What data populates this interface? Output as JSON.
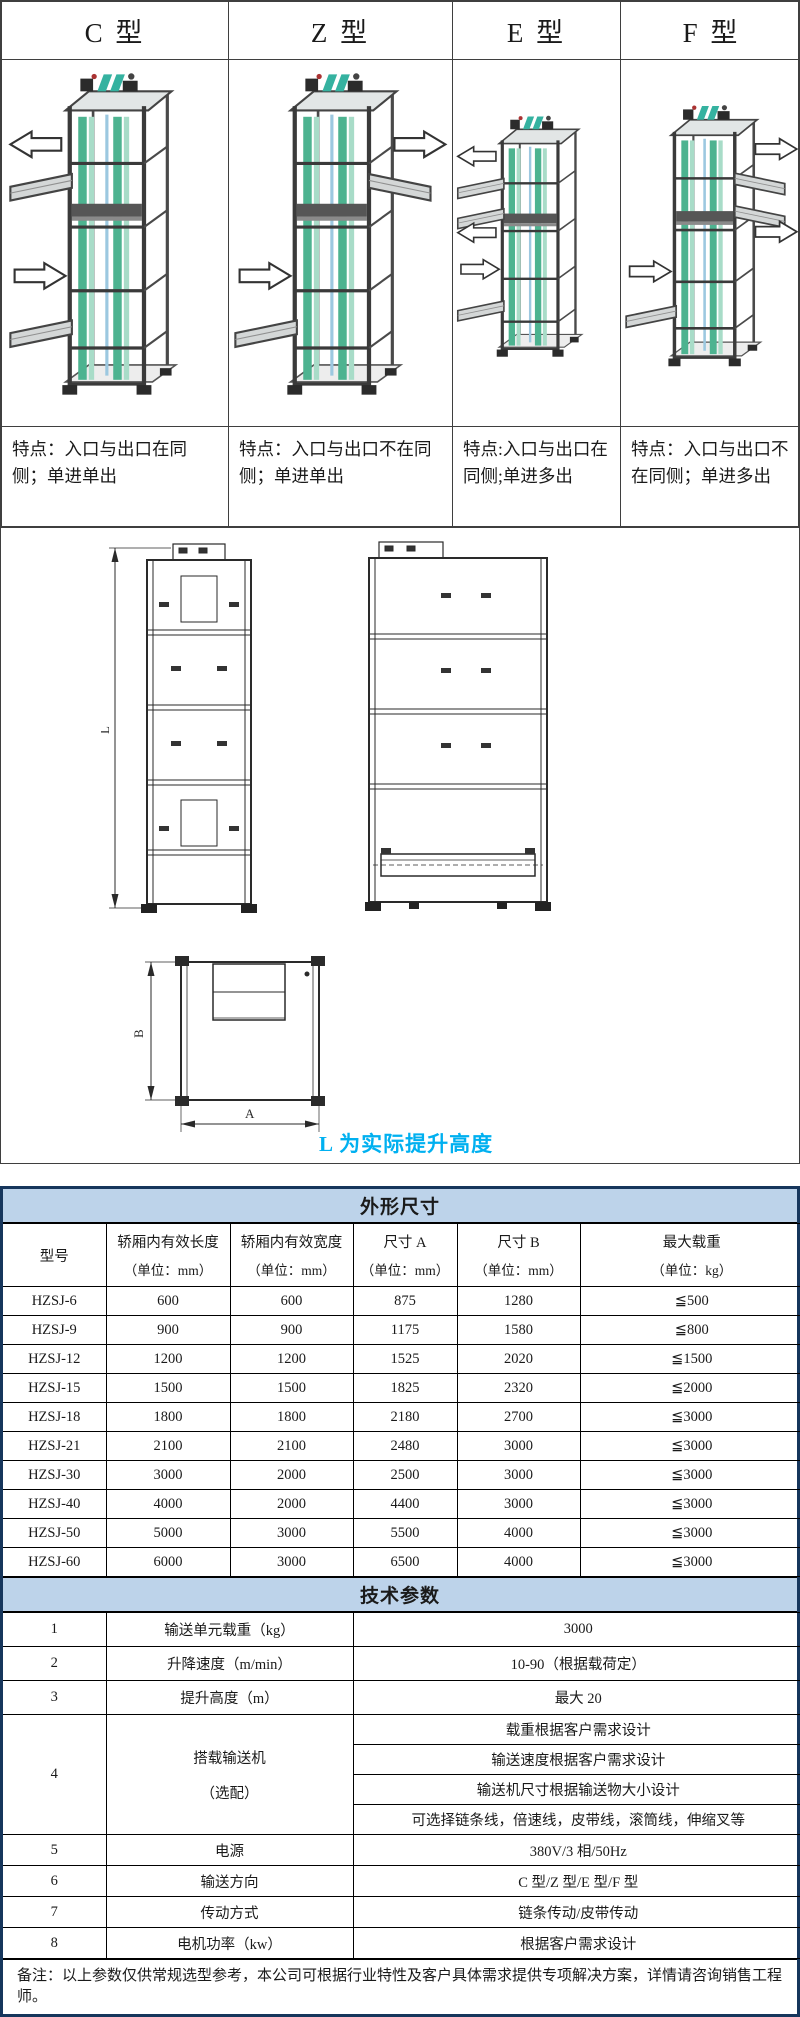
{
  "comparison": {
    "types": [
      {
        "label": "C 型",
        "feature": "特点：入口与出口在同侧；单进单出"
      },
      {
        "label": "Z 型",
        "feature": "特点：入口与出口不在同侧；单进单出"
      },
      {
        "label": "E 型",
        "feature": "特点:入口与出口在同侧;单进多出"
      },
      {
        "label": "F 型",
        "feature": "特点：入口与出口不在同侧；单进多出"
      }
    ]
  },
  "drawing": {
    "dim_l": "L",
    "dim_b": "B",
    "dim_a": "A",
    "note": "L 为实际提升高度",
    "note_color": "#00b0f0"
  },
  "dimensions_table": {
    "title": "外形尺寸",
    "headers": {
      "model": "型号",
      "length": "轿厢内有效长度",
      "length_unit": "（单位：mm）",
      "width": "轿厢内有效宽度",
      "width_unit": "（单位：mm）",
      "dim_a": "尺寸 A",
      "dim_a_unit": "（单位：mm）",
      "dim_b": "尺寸 B",
      "dim_b_unit": "（单位：mm）",
      "load": "最大载重",
      "load_unit": "（单位：kg）"
    },
    "rows": [
      {
        "model": "HZSJ-6",
        "length": "600",
        "width": "600",
        "a": "875",
        "b": "1280",
        "load": "≦500"
      },
      {
        "model": "HZSJ-9",
        "length": "900",
        "width": "900",
        "a": "1175",
        "b": "1580",
        "load": "≦800"
      },
      {
        "model": "HZSJ-12",
        "length": "1200",
        "width": "1200",
        "a": "1525",
        "b": "2020",
        "load": "≦1500"
      },
      {
        "model": "HZSJ-15",
        "length": "1500",
        "width": "1500",
        "a": "1825",
        "b": "2320",
        "load": "≦2000"
      },
      {
        "model": "HZSJ-18",
        "length": "1800",
        "width": "1800",
        "a": "2180",
        "b": "2700",
        "load": "≦3000"
      },
      {
        "model": "HZSJ-21",
        "length": "2100",
        "width": "2100",
        "a": "2480",
        "b": "3000",
        "load": "≦3000"
      },
      {
        "model": "HZSJ-30",
        "length": "3000",
        "width": "2000",
        "a": "2500",
        "b": "3000",
        "load": "≦3000"
      },
      {
        "model": "HZSJ-40",
        "length": "4000",
        "width": "2000",
        "a": "4400",
        "b": "3000",
        "load": "≦3000"
      },
      {
        "model": "HZSJ-50",
        "length": "5000",
        "width": "3000",
        "a": "5500",
        "b": "4000",
        "load": "≦3000"
      },
      {
        "model": "HZSJ-60",
        "length": "6000",
        "width": "3000",
        "a": "6500",
        "b": "4000",
        "load": "≦3000"
      }
    ]
  },
  "params_table": {
    "title": "技术参数",
    "rows": [
      {
        "no": "1",
        "name": "输送单元载重（kg）",
        "value": "3000"
      },
      {
        "no": "2",
        "name": "升降速度（m/min）",
        "value": "10-90（根据载荷定）"
      },
      {
        "no": "3",
        "name": "提升高度（m）",
        "value": "最大 20"
      },
      {
        "no": "4",
        "name": "搭载输送机",
        "name2": "（选配）",
        "values": [
          "载重根据客户需求设计",
          "输送速度根据客户需求设计",
          "输送机尺寸根据输送物大小设计",
          "可选择链条线，倍速线，皮带线，滚筒线，伸缩叉等"
        ]
      },
      {
        "no": "5",
        "name": "电源",
        "value": "380V/3 相/50Hz"
      },
      {
        "no": "6",
        "name": "输送方向",
        "value": "C 型/Z 型/E 型/F 型"
      },
      {
        "no": "7",
        "name": "传动方式",
        "value": "链条传动/皮带传动"
      },
      {
        "no": "8",
        "name": "电机功率（kw）",
        "value": "根据客户需求设计"
      }
    ]
  },
  "footer": {
    "note": "备注：以上参数仅供常规选型参考，本公司可根据行业特性及客户具体需求提供专项解决方案，详情请咨询销售工程师。"
  }
}
